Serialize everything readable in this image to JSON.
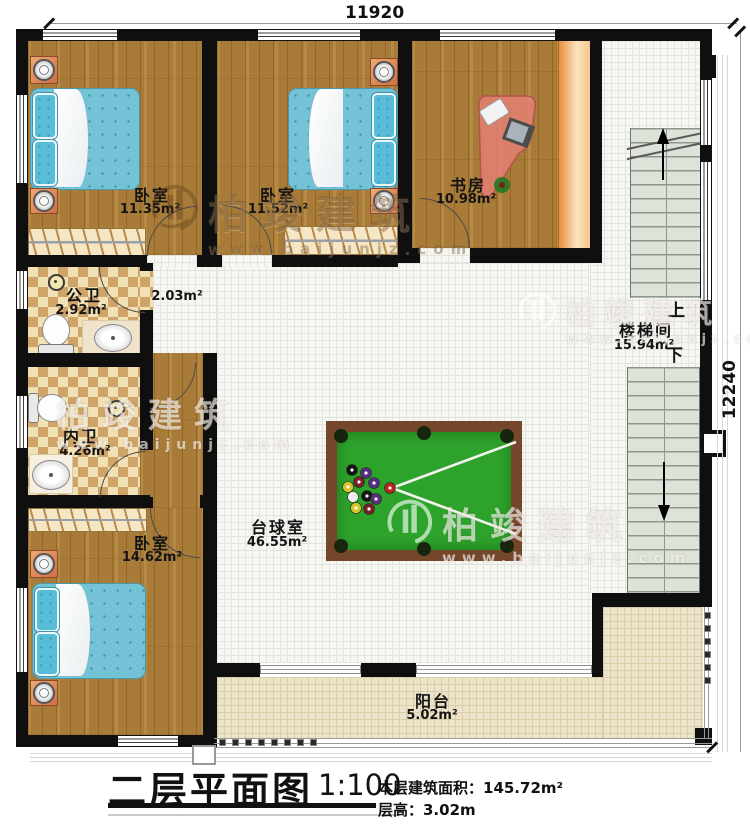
{
  "meta": {
    "title": "二层平面图",
    "scale": "1:100",
    "floor_area_label": "本层建筑面积：145.72m²",
    "floor_height_label": "层高：3.02m"
  },
  "dimensions": {
    "top_mm": "11920",
    "right_mm": "12240"
  },
  "rooms": [
    {
      "id": "bedroom-1",
      "name": "卧室",
      "area": "11.35m²"
    },
    {
      "id": "bedroom-2",
      "name": "卧室",
      "area": "11.52m²"
    },
    {
      "id": "study",
      "name": "书房",
      "area": "10.98m²"
    },
    {
      "id": "hall",
      "name": "",
      "area": "2.03m²"
    },
    {
      "id": "public-bathroom",
      "name": "公卫",
      "area": "2.92m²"
    },
    {
      "id": "ensuite-bathroom",
      "name": "内卫",
      "area": "4.26m²"
    },
    {
      "id": "bedroom-3",
      "name": "卧室",
      "area": "14.62m²"
    },
    {
      "id": "billiards-room",
      "name": "台球室",
      "area": "46.55m²"
    },
    {
      "id": "stair-hall",
      "name": "楼梯间",
      "area": "15.94m²"
    },
    {
      "id": "balcony",
      "name": "阳台",
      "area": "5.02m²"
    }
  ],
  "stairs": {
    "up": "上",
    "down": "下"
  },
  "watermark": {
    "brand": "柏竣建筑",
    "url": "www.baijunjz.com"
  },
  "colors": {
    "wall": "#0f0f0f",
    "wood_floor": "#a87c38",
    "bathroom_tile_dark": "#cfa468",
    "bathroom_tile_light": "#f1e1b5",
    "balcony_tile": "#ebe3ca",
    "bed_fabric": "#74c2d6",
    "pool_felt": "#2ea32c",
    "pool_frame": "#74462a",
    "stair_tread": "#dde3d8"
  }
}
